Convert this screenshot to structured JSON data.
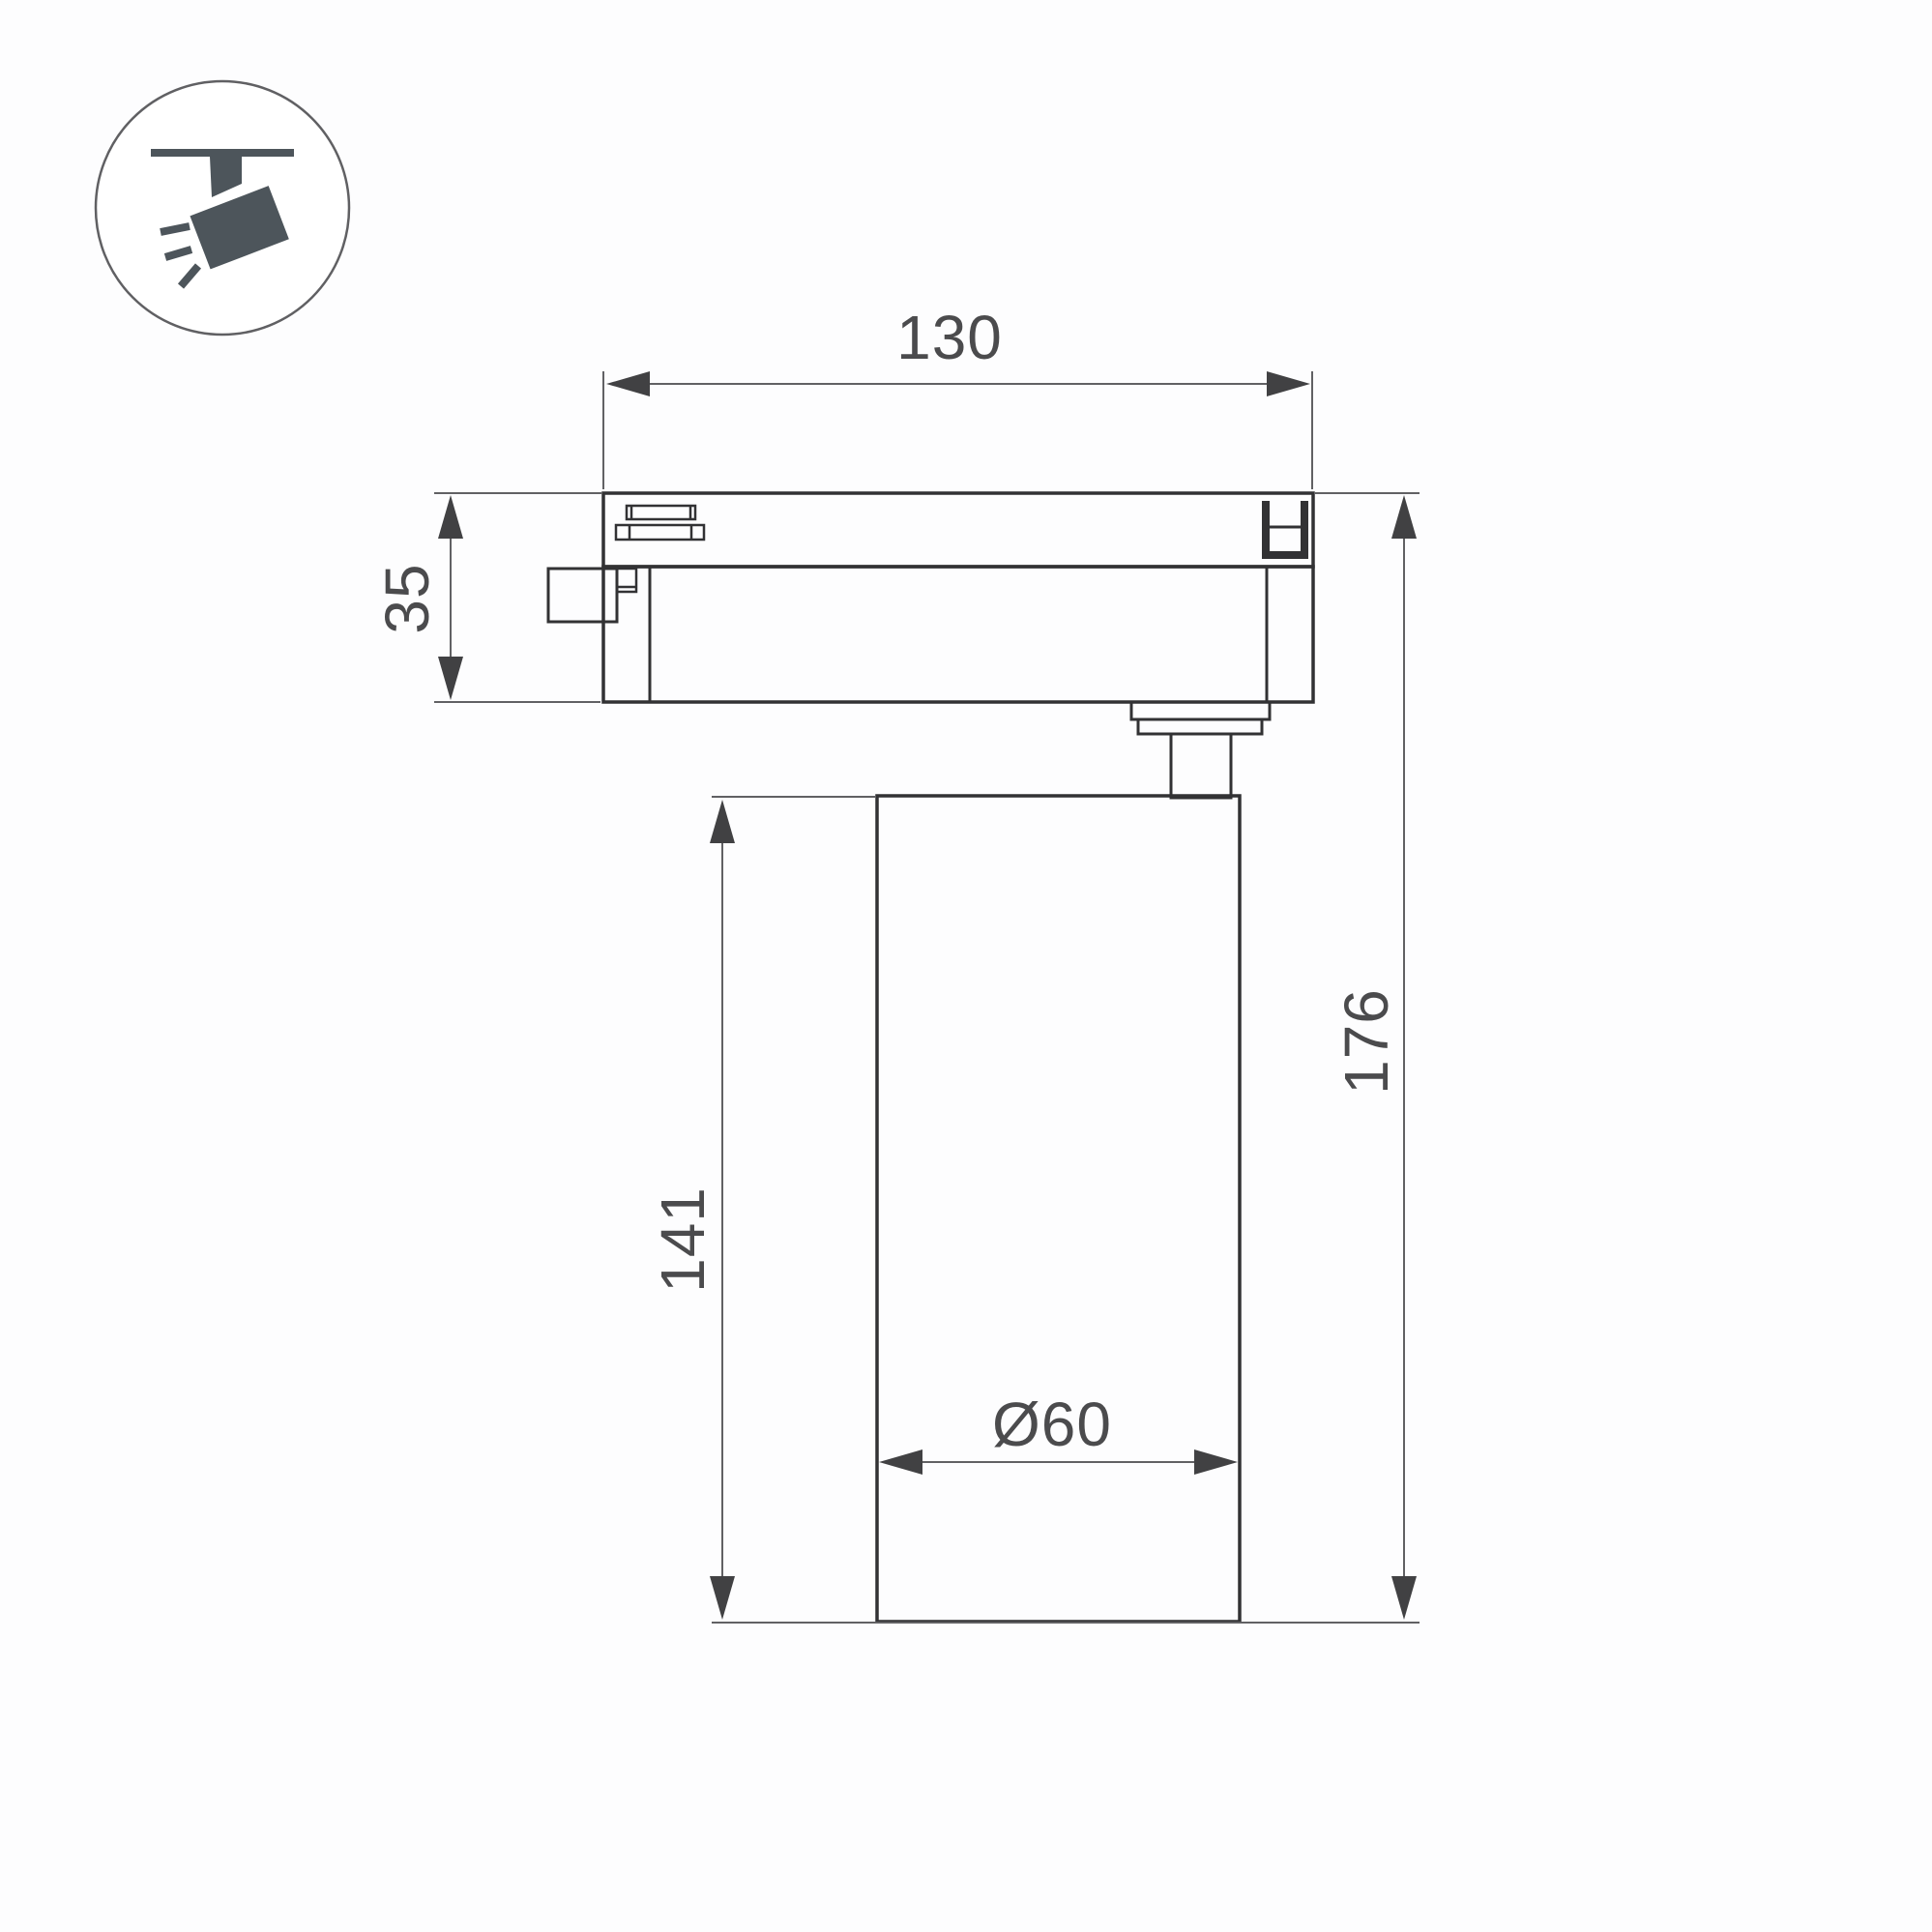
{
  "drawing": {
    "kind": "technical-dimension-drawing",
    "dimensions": {
      "track_adapter_width": {
        "label": "130"
      },
      "track_adapter_height": {
        "label": "35"
      },
      "lamp_body_height": {
        "label": "141"
      },
      "total_height": {
        "label": "176"
      },
      "lamp_body_diameter": {
        "label": "Ø60"
      }
    },
    "icon": {
      "name": "track-spotlight-icon",
      "color": "#4d555b",
      "circle_stroke": "#606063"
    },
    "colors": {
      "background": "#fdfdfe",
      "object_line": "#323234",
      "dimension_line": "#616164",
      "arrow_fill": "#414143",
      "text": "#4b4b4d"
    }
  }
}
